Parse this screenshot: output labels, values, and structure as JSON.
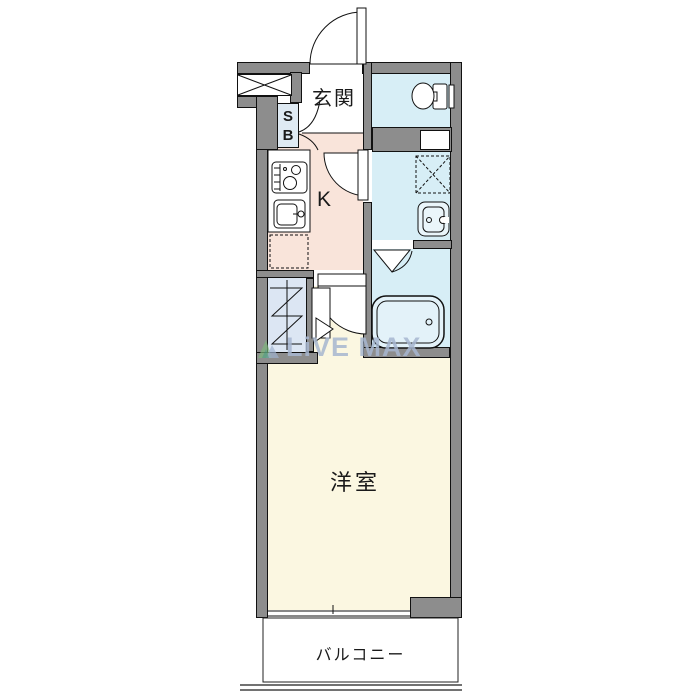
{
  "labels": {
    "entrance": "玄関",
    "kitchen": "K",
    "room": "洋室",
    "balcony": "バルコニー",
    "shoe_box_top": "S",
    "shoe_box_bottom": "B"
  },
  "watermark": {
    "text": "LiVE MAX"
  },
  "colors": {
    "wall": "#8d8d8d",
    "outline": "#111111",
    "kitchen_floor": "#f9e4da",
    "wet_area_floor": "#d7eef6",
    "closet_floor": "#dce6f3",
    "room_floor": "#fbf7e1",
    "shoe_box": "#dfeaf3",
    "watermark_text": "#a7b7d0"
  },
  "icons": {
    "entrance_door": "door-swing-icon",
    "shoe_box_doors": "double-door-swing-icon",
    "washroom_door": "door-swing-icon",
    "room_door": "door-swing-icon",
    "bath_door": "folding-door-icon",
    "closet_door": "folding-door-icon",
    "toilet": "toilet-icon",
    "pipe_space": "pipe-space-box",
    "washer_space": "washing-machine-space-icon",
    "washbasin": "washbasin-icon",
    "bathtub": "bathtub-icon",
    "stove": "stove-icon",
    "kitchen_sink": "kitchen-sink-icon",
    "fridge_space": "fridge-space-icon",
    "closet_hanger": "hanger-pipe-icon",
    "meter_box": "hatched-void-icon",
    "window": "sliding-window-icon",
    "balcony_rail": "balcony-railing"
  }
}
